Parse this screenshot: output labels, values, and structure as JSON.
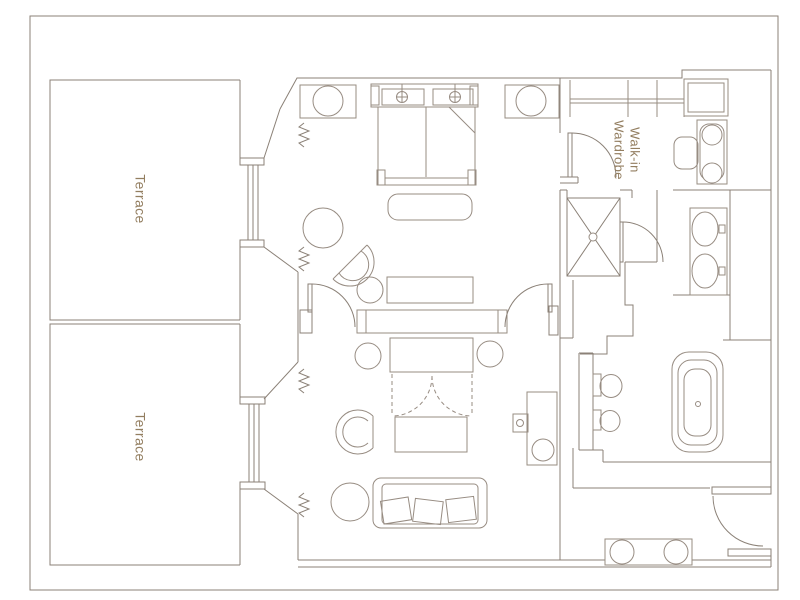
{
  "floor_plan": {
    "labels": {
      "terrace_top": "Terrace",
      "terrace_bottom": "Terrace",
      "walk_in_wardrobe": "Walk-in\nWardrobe"
    },
    "colors": {
      "background": "#ffffff",
      "wall": "#8b8177",
      "furniture": "#978c82",
      "label": "#937e60",
      "frame": "#8b8177"
    },
    "fixtures": [
      "double-bed",
      "pillows",
      "reading-lights",
      "headboard",
      "bed-bench",
      "nightstand-left",
      "nightstand-right",
      "table-lamps",
      "bedroom-round-table",
      "bedroom-armchair",
      "side-table",
      "dresser",
      "partition-console",
      "swing-doors",
      "curtain-symbols",
      "glazed-windows",
      "tv-console",
      "flanking-stools",
      "dashed-cabinet-doors",
      "coffee-table",
      "lounge-armchair",
      "sofa",
      "sofa-cushions",
      "sofa-side-table",
      "desk",
      "desk-lamp",
      "desk-chair",
      "wardrobe-rail",
      "wardrobe-door",
      "corner-cabinet",
      "dressing-table",
      "dressing-stool",
      "shower",
      "shower-door",
      "double-sink-vanity",
      "toilet",
      "bidet",
      "bathtub",
      "luggage-bench",
      "entry-door"
    ]
  }
}
